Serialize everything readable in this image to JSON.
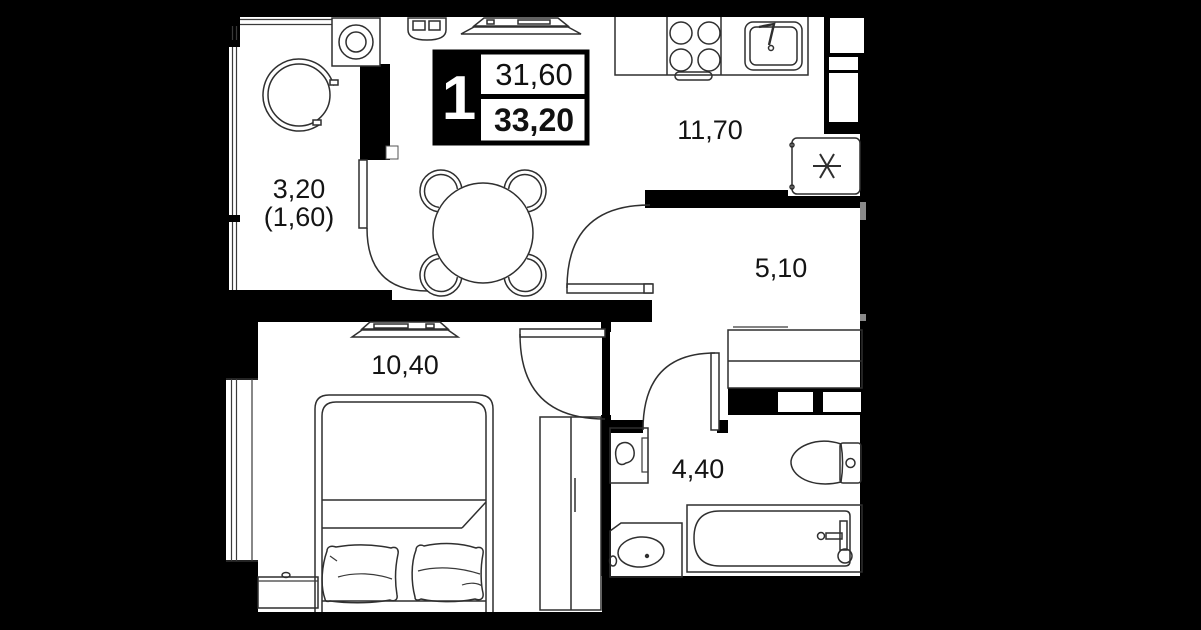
{
  "plan": {
    "type": "apartment-floor-plan",
    "badge": {
      "rooms_count": "1",
      "living_area": "31,60",
      "total_area": "33,20"
    },
    "rooms": {
      "balcony": {
        "area": "3,20",
        "area_reduced": "(1,60)"
      },
      "kitchen_living": {
        "area": "11,70"
      },
      "hallway": {
        "area": "5,10"
      },
      "bedroom": {
        "area": "10,40"
      },
      "bathroom": {
        "area": "4,40"
      }
    },
    "colors": {
      "canvas": "#000000",
      "floor": "#ffffff",
      "wall": "#000000",
      "furniture_line": "#2f2f2f"
    }
  }
}
